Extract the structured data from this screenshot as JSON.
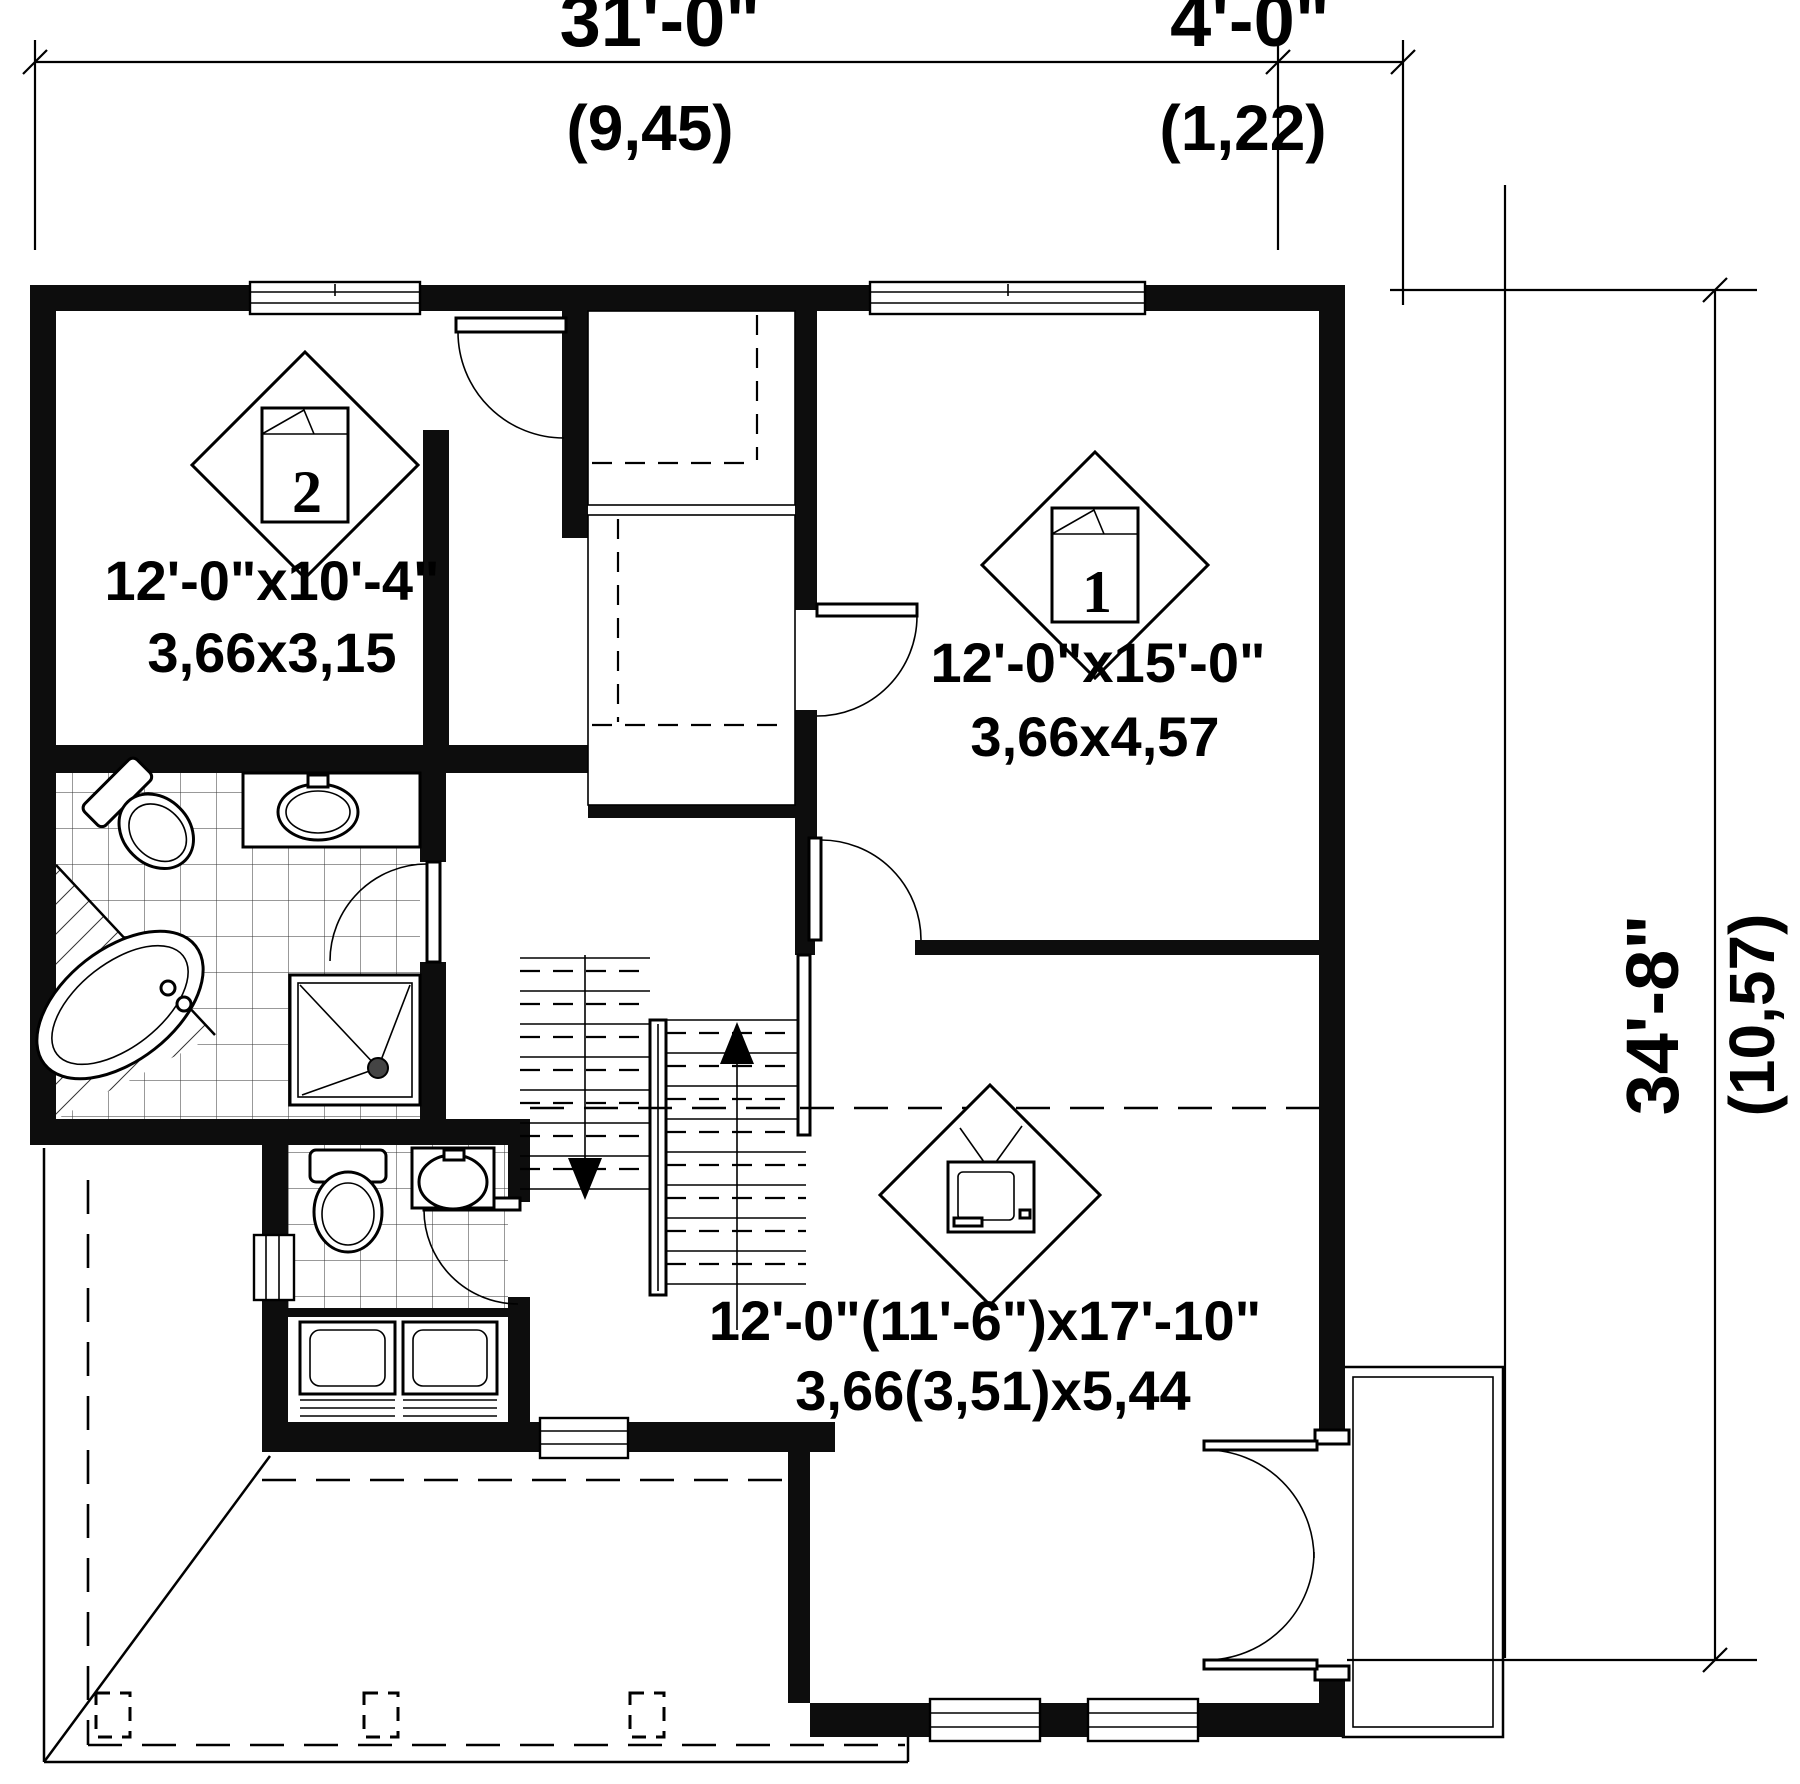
{
  "title": "second-floor-plan",
  "dimensions": {
    "top_main": {
      "imperial": "31'-0\"",
      "metric": "(9,45)"
    },
    "top_right": {
      "imperial": "4'-0\"",
      "metric": "(1,22)"
    },
    "right": {
      "imperial": "34'-8\"",
      "metric": "(10,57)"
    }
  },
  "rooms": [
    {
      "id": "bedroom-2",
      "symbol": "2",
      "icon": "bed-icon",
      "size_imperial": "12'-0\"x10'-4\"",
      "size_metric": "3,66x3,15"
    },
    {
      "id": "bedroom-1",
      "symbol": "1",
      "icon": "bed-icon",
      "size_imperial": "12'-0\"x15'-0\"",
      "size_metric": "3,66x4,57"
    },
    {
      "id": "family-room",
      "symbol": "",
      "icon": "tv-icon",
      "size_imperial": "12'-0\"(11'-6\")x17'-10\"",
      "size_metric": "3,66(3,51)x5,44"
    }
  ],
  "features": {
    "stairs": {
      "up_arrow": "up",
      "down_arrow": "down"
    },
    "fixtures": [
      "corner-bathtub",
      "shower",
      "toilet",
      "vanity-sink",
      "toilet-2",
      "sink-2",
      "washer",
      "dryer"
    ],
    "openings": [
      "windows",
      "interior-doors",
      "french-door",
      "balcony",
      "porch"
    ]
  },
  "colors": {
    "ink": "#000000",
    "paper": "#ffffff"
  }
}
